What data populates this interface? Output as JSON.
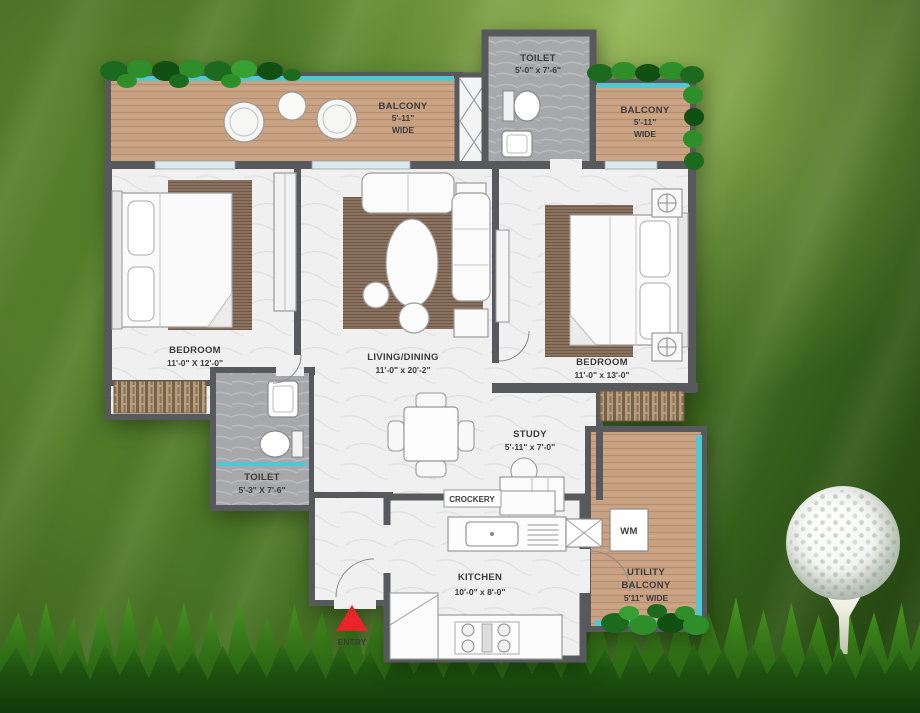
{
  "plan": {
    "rooms": {
      "toilet_top": {
        "name": "TOILET",
        "dims": "5'-0\" x 7'-6\""
      },
      "balcony_top_left": {
        "name": "BALCONY",
        "dim": "5'-11\"",
        "wide": "WIDE"
      },
      "balcony_top_right": {
        "name": "BALCONY",
        "dim": "5'-11\"",
        "wide": "WIDE"
      },
      "bedroom_left": {
        "name": "BEDROOM",
        "dims": "11'-0\" X 12'-0\""
      },
      "living_dining": {
        "name": "LIVING/DINING",
        "dims": "11'-0\" x 20'-2\""
      },
      "bedroom_right": {
        "name": "BEDROOM",
        "dims": "11'-0\" x 13'-0\""
      },
      "toilet_bottom": {
        "name": "TOILET",
        "dims": "5'-3\" X 7'-6\""
      },
      "study": {
        "name": "STUDY",
        "dims": "5'-11\" x 7'-0\""
      },
      "crockery": {
        "name": "CROCKERY"
      },
      "kitchen": {
        "name": "KITCHEN",
        "dims": "10'-0\" x 8'-0\""
      },
      "utility_balcony": {
        "name": "UTILITY",
        "name2": "BALCONY",
        "dim": "5'11\" WIDE"
      },
      "wm": {
        "name": "WM"
      }
    },
    "entry": {
      "label": "ENTRY"
    },
    "colors": {
      "wall": "#58595c",
      "balcony_floor": "#c8a182",
      "toilet_floor": "#a6a8ac",
      "marble_floor": "#f0f0f1",
      "railing_teal": "#4fc8d4",
      "hedge_green": "#1c6a1d",
      "rug_brown": "#8b7260",
      "entry_arrow_red": "#e8232a",
      "label_text": "#3b3b3b",
      "background_green": "#426c21",
      "grass_green": "#205410",
      "golf_ball_white": "#f5f7f3"
    }
  }
}
